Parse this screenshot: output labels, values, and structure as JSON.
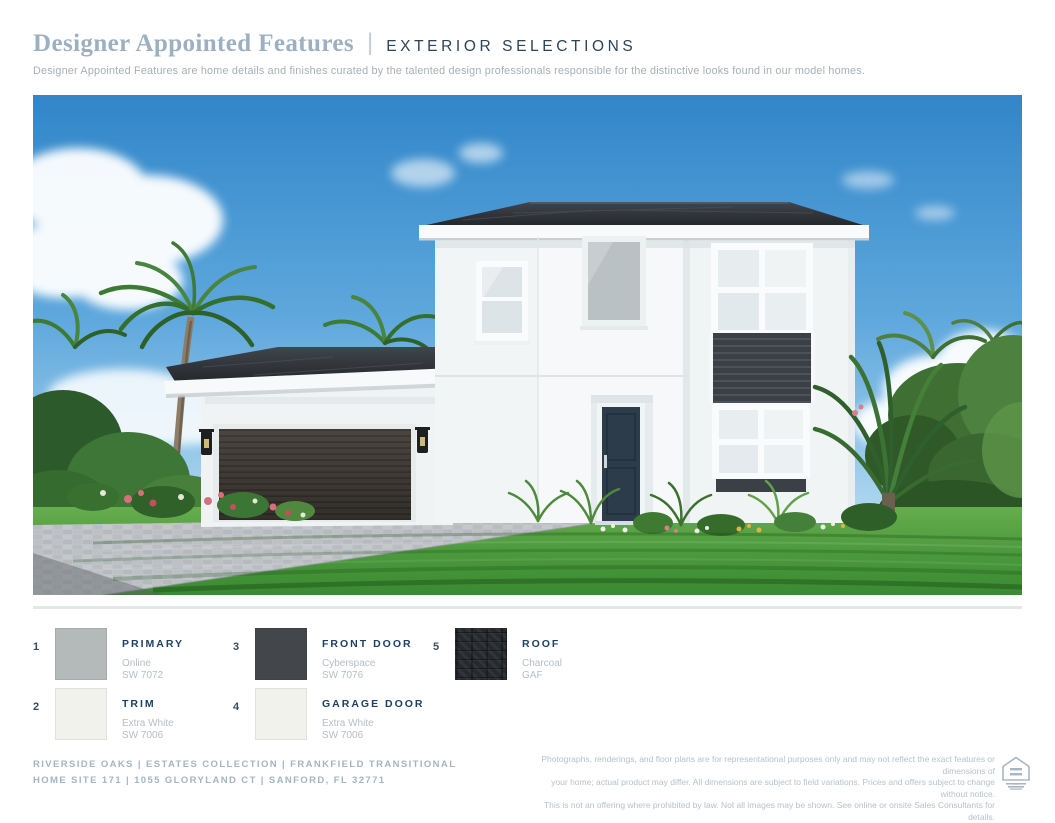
{
  "header": {
    "title": "Designer Appointed Features",
    "divider": "|",
    "subtitle": "EXTERIOR SELECTIONS",
    "description": "Designer Appointed Features are home details and finishes curated by the talented design professionals responsible for the distinctive looks found in our model homes."
  },
  "swatches": [
    {
      "number": "1",
      "label": "PRIMARY",
      "name": "Online",
      "code": "SW 7072",
      "color": "#b4b9ba"
    },
    {
      "number": "2",
      "label": "TRIM",
      "name": "Extra White",
      "code": "SW 7006",
      "color": "#f2f2ed"
    },
    {
      "number": "3",
      "label": "FRONT DOOR",
      "name": "Cyberspace",
      "code": "SW 7076",
      "color": "#43474c"
    },
    {
      "number": "4",
      "label": "GARAGE DOOR",
      "name": "Extra White",
      "code": "SW 7006",
      "color": "#f2f2ed"
    },
    {
      "number": "5",
      "label": "ROOF",
      "name": "Charcoal",
      "code": "GAF",
      "color": "#26292d",
      "texture": "shingle"
    }
  ],
  "footer": {
    "community_line1": "RIVERSIDE OAKS | ESTATES COLLECTION | FRANKFIELD TRANSITIONAL",
    "community_line2": "HOME SITE 171 | 1055 GLORYLAND CT | SANFORD, FL 32771",
    "disclaimer_line1": "Photographs, renderings, and floor plans are for representational purposes only and may not reflect the exact features or dimensions of",
    "disclaimer_line2": "your home; actual product may differ. All dimensions are subject to field variations. Prices and offers subject to change without notice.",
    "disclaimer_line3": "This is not an offering where prohibited by law. Not all images may be shown. See online or onsite Sales Consultants for details.",
    "eho_icon": "equal-housing-opportunity"
  },
  "colors": {
    "accent_navy": "#1d4062",
    "title_blue": "#9cb0c1",
    "muted_text": "#b5bec5",
    "footer_text": "#a3b5c3",
    "divider": "#e3e8e4"
  }
}
